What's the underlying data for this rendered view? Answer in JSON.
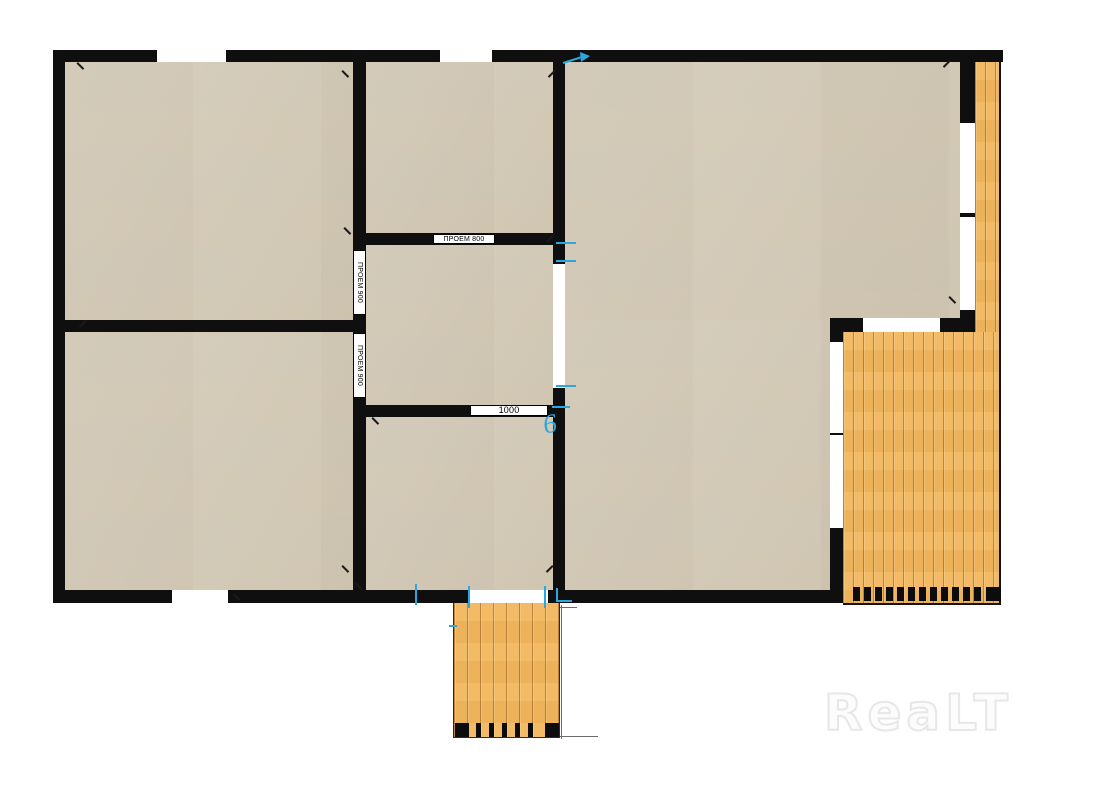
{
  "watermark": {
    "text": "ReaLT"
  },
  "plan": {
    "colors": {
      "wall": "#0f0f0f",
      "floor": "#ddd5c4",
      "deck": "#f2b75e",
      "accent": "#2ba7e0",
      "watermark": "#e7e7e7"
    },
    "floors": [
      [
        65,
        62,
        288,
        258
      ],
      [
        65,
        332,
        288,
        258
      ],
      [
        366,
        62,
        187,
        171
      ],
      [
        366,
        245,
        187,
        160
      ],
      [
        366,
        417,
        187,
        173
      ],
      [
        565,
        62,
        395,
        258
      ],
      [
        565,
        320,
        265,
        270
      ]
    ],
    "walls": [
      [
        53,
        50,
        950,
        12
      ],
      [
        53,
        50,
        12,
        553
      ],
      [
        53,
        590,
        790,
        13
      ],
      [
        960,
        50,
        15,
        282
      ],
      [
        830,
        318,
        145,
        14
      ],
      [
        830,
        332,
        13,
        271
      ],
      [
        353,
        50,
        13,
        540
      ],
      [
        65,
        320,
        288,
        12
      ],
      [
        553,
        50,
        12,
        540
      ],
      [
        353,
        233,
        212,
        12
      ],
      [
        353,
        405,
        212,
        12
      ]
    ],
    "windows": [
      [
        157,
        50,
        69,
        12
      ],
      [
        440,
        50,
        52,
        12
      ],
      [
        172,
        590,
        56,
        13
      ],
      [
        468,
        590,
        80,
        13
      ],
      [
        960,
        123,
        15,
        90
      ],
      [
        960,
        217,
        15,
        93
      ],
      [
        863,
        318,
        77,
        14
      ],
      [
        830,
        342,
        13,
        91
      ],
      [
        830,
        435,
        13,
        93
      ],
      [
        553,
        264,
        12,
        124
      ]
    ],
    "decks": [
      {
        "rect": [
          975,
          62,
          26,
          270
        ],
        "cls": "strip",
        "name": "deck-strip-right"
      },
      {
        "rect": [
          843,
          332,
          158,
          273
        ],
        "cls": "big",
        "name": "deck-terrace-right"
      },
      {
        "rect": [
          453,
          603,
          107,
          135
        ],
        "cls": "porch",
        "name": "deck-porch-bottom"
      }
    ],
    "deck_marks": [
      [
        853,
        587,
        7,
        14
      ],
      [
        864,
        587,
        7,
        14
      ],
      [
        875,
        587,
        7,
        14
      ],
      [
        886,
        587,
        7,
        14
      ],
      [
        897,
        587,
        7,
        14
      ],
      [
        908,
        587,
        7,
        14
      ],
      [
        919,
        587,
        7,
        14
      ],
      [
        930,
        587,
        7,
        14
      ],
      [
        941,
        587,
        7,
        14
      ],
      [
        952,
        587,
        7,
        14
      ],
      [
        963,
        587,
        7,
        14
      ],
      [
        974,
        587,
        7,
        14
      ],
      [
        986,
        587,
        15,
        14
      ],
      [
        455,
        723,
        14,
        14
      ],
      [
        476,
        723,
        5,
        14
      ],
      [
        489,
        723,
        5,
        14
      ],
      [
        502,
        723,
        5,
        14
      ],
      [
        515,
        723,
        5,
        14
      ],
      [
        528,
        723,
        5,
        14
      ],
      [
        545,
        723,
        14,
        14
      ]
    ],
    "labels": [
      {
        "text": "ПРОЕМ 800",
        "x": 433,
        "y": 234,
        "w": 62,
        "h": 10,
        "dir": "h",
        "fs": 7
      },
      {
        "text": "ПРОЕМ 900",
        "x": 353,
        "y": 250,
        "w": 13,
        "h": 65,
        "dir": "v",
        "fs": 7
      },
      {
        "text": "ПРОЕМ 900",
        "x": 353,
        "y": 333,
        "w": 13,
        "h": 65,
        "dir": "v",
        "fs": 7
      },
      {
        "text": "1000",
        "x": 470,
        "y": 405,
        "w": 78,
        "h": 11,
        "dir": "h",
        "fs": 9
      }
    ],
    "black_ticks": [
      [
        80,
        66,
        45
      ],
      [
        82,
        324,
        -45
      ],
      [
        345,
        74,
        45
      ],
      [
        551,
        74,
        -45
      ],
      [
        347,
        231,
        45
      ],
      [
        549,
        239,
        -45
      ],
      [
        375,
        421,
        45
      ],
      [
        549,
        569,
        -45
      ],
      [
        358,
        586,
        45
      ],
      [
        236,
        597,
        45
      ],
      [
        946,
        64,
        -45
      ],
      [
        952,
        300,
        45
      ],
      [
        345,
        569,
        45
      ]
    ],
    "cyan_ticks": [
      [
        556,
        242,
        20,
        2
      ],
      [
        556,
        260,
        20,
        2
      ],
      [
        556,
        385,
        20,
        2
      ],
      [
        552,
        406,
        18,
        2
      ],
      [
        415,
        584,
        2,
        21
      ],
      [
        468,
        586,
        2,
        22
      ],
      [
        544,
        586,
        2,
        22
      ],
      [
        556,
        588,
        2,
        14
      ],
      [
        449,
        625,
        8,
        2
      ],
      [
        558,
        600,
        14,
        2
      ]
    ],
    "dim_lines": [
      [
        561,
        605,
        1,
        134
      ],
      [
        560,
        607,
        17,
        1
      ],
      [
        560,
        736,
        38,
        1
      ]
    ],
    "arrow": {
      "x": 562,
      "y": 52
    },
    "cyan_glyph": {
      "text": "6",
      "x": 543,
      "y": 408,
      "fs": 27
    }
  }
}
